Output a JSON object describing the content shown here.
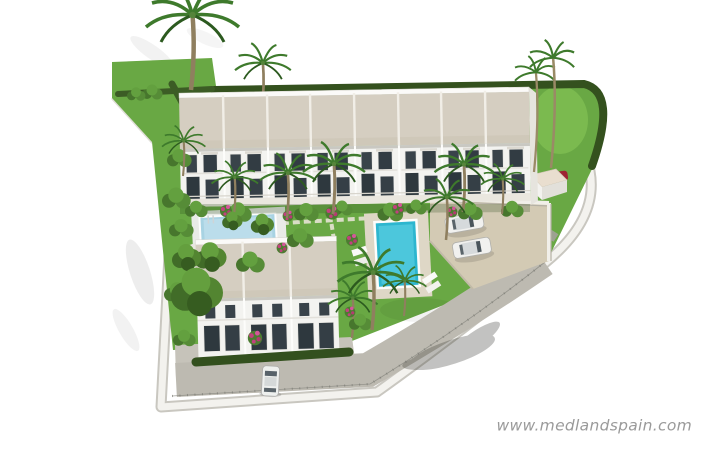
{
  "watermark": {
    "text": "www.medlandspain.com",
    "color": "#9a9a9a"
  },
  "scene": {
    "description": "Aerial 3D architectural rendering of a walled townhouse development with communal pools, gardens, palm trees and a parking area, isolated on a white background",
    "colors": {
      "background": "#ffffff",
      "lawn": "#69a844",
      "hedge": "#34511e",
      "roof": "#d5cec1",
      "facade": "#f3f3f0",
      "window": "#39434a",
      "pool_water": "#2db6cf",
      "kids_pool_water": "#a8d3e3",
      "pool_deck": "#ded7c6",
      "parking": "#d3cab4",
      "road": "#bdbab1",
      "wall": "#f3f2ee",
      "palm_frond": "#3e7a2c",
      "flowers": "#c2417e",
      "red_car": "#9e2433",
      "white_car": "#f1f1ef"
    },
    "counts": {
      "top_row_townhouse_units": 8,
      "lower_block_townhouse_units": 3,
      "swimming_pools": 2,
      "white_cars_in_parking": 2,
      "white_cars_on_street": 1,
      "red_cars_at_entrance": 1,
      "tall_palm_trees": 3
    }
  }
}
